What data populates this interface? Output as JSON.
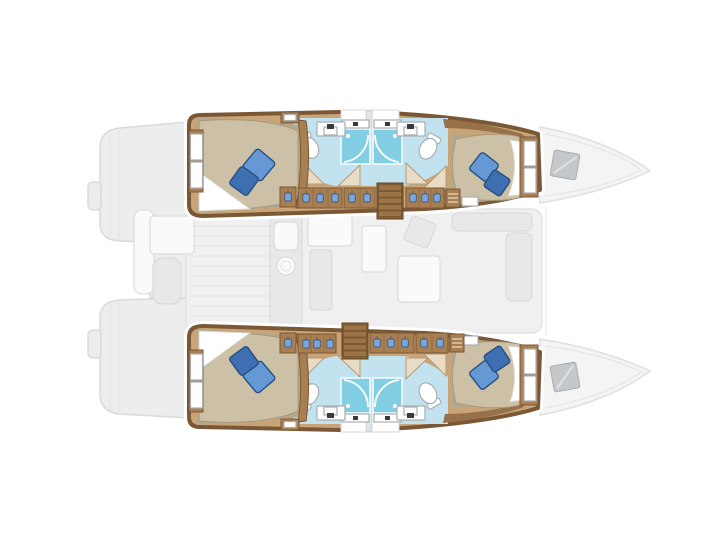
{
  "colors": {
    "hullWall": "#7a5836",
    "wallLight": "#96714a",
    "floorWood": "#c9a478",
    "furnitureWood": "#a97e50",
    "stairWood": "#8a6134",
    "stairTread": "#9c7347",
    "bathFloor": "#c2e2ef",
    "showerGlass": "#82cfe3",
    "mattress": "#ccc0a7",
    "mattressShade": "#b3a88d",
    "sheet": "#ffffff",
    "fixtureWhite": "#ffffff",
    "fixtureStroke": "#a9aeb2",
    "faucetDark": "#3a3a3a",
    "pillowLight": "#6598d4",
    "pillowDark": "#3e6fb2",
    "pillowStroke": "#27507f",
    "hangerBlue": "#7aa7dc",
    "deckFill": "#ededed",
    "deckStroke": "#d9dadb",
    "deckLine": "#e2e3e4",
    "saloonFill": "#f0f0f0",
    "furnFaint": "#e8e8e9",
    "furnFaintStroke": "#d7d7d8",
    "whiteFaint": "#fafafa",
    "hatchFill": "#c4c8ca",
    "hatchStroke": "#a9adb0"
  },
  "plan": {
    "vessel_type": "catamaran",
    "view": "catamaran deck plan, top view, bow to the right",
    "hulls": [
      {
        "name": "port hull",
        "position": "top",
        "layout": [
          "aft double cabin",
          "aft bathroom with toilet and sink",
          "two shower stalls",
          "forward bathroom with toilet and sink",
          "forward double cabin",
          "corridor with hanging lockers",
          "companionway stairs"
        ]
      },
      {
        "name": "starboard hull",
        "position": "bottom",
        "layout": [
          "aft double cabin",
          "aft bathroom with toilet and sink",
          "two shower stalls",
          "forward bathroom with toilet and sink",
          "forward double cabin",
          "corridor with hanging lockers",
          "companionway stairs"
        ]
      }
    ],
    "bridgedeck": {
      "aft": "cockpit with table and bench (faint)",
      "center": "saloon with galley, chart seat and dining area (faint)",
      "forward": "bow decks with deck hatches (faint)"
    },
    "counts": {
      "double_cabins": 4,
      "toilets": 4,
      "shower_stalls": 4,
      "companionway_stairs": 2,
      "bow_deck_hatches": 2,
      "berth_pillows": 8
    }
  }
}
